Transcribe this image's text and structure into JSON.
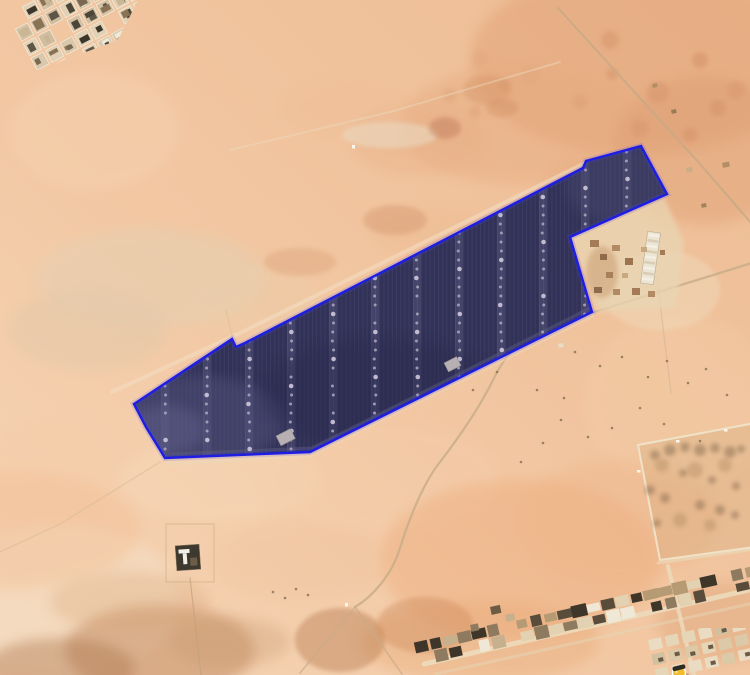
{
  "app": {
    "view": "satellite-imagery",
    "description": "Desert aerial view with a solar farm boundary overlay"
  },
  "canvas": {
    "width": 750,
    "height": 675
  },
  "sand": {
    "base_light": "#f6d6b8",
    "base_mid": "#f2c7a2",
    "base_deep": "#edbc94",
    "blotches": [
      [
        640,
        60,
        170,
        95,
        "#e2a176",
        0.5,
        0
      ],
      [
        520,
        125,
        120,
        60,
        "#e5a77d",
        0.4,
        0
      ],
      [
        705,
        150,
        90,
        75,
        "#dc9a6e",
        0.38,
        0
      ],
      [
        420,
        140,
        70,
        35,
        "#e7ad85",
        0.35,
        0
      ],
      [
        345,
        108,
        65,
        30,
        "#eebc95",
        0.3,
        0
      ],
      [
        150,
        278,
        115,
        50,
        "#e4cfb2",
        0.5,
        0
      ],
      [
        88,
        330,
        80,
        40,
        "#ddc7a9",
        0.38,
        0
      ],
      [
        252,
        300,
        70,
        32,
        "#e9d0ae",
        0.3,
        0
      ],
      [
        95,
        130,
        85,
        60,
        "#f6d2b0",
        0.45,
        0
      ],
      [
        40,
        480,
        70,
        60,
        "#f4cba6",
        0.3,
        0
      ],
      [
        220,
        480,
        100,
        42,
        "#f7d9b9",
        0.4,
        0
      ],
      [
        380,
        478,
        120,
        55,
        "#f5cfad",
        0.35,
        0
      ],
      [
        680,
        400,
        95,
        85,
        "#f3cda6",
        0.4,
        0
      ],
      [
        660,
        290,
        60,
        40,
        "#f0dcbf",
        0.45,
        1
      ],
      [
        520,
        560,
        140,
        80,
        "#edaa7a",
        0.42,
        0
      ],
      [
        620,
        520,
        100,
        60,
        "#eeb286",
        0.35,
        0
      ],
      [
        480,
        642,
        120,
        40,
        "#e8a874",
        0.38,
        0
      ],
      [
        720,
        622,
        62,
        40,
        "#d99a6c",
        0.32,
        0
      ],
      [
        60,
        600,
        120,
        75,
        "#f4dec4",
        0.6,
        0
      ],
      [
        0,
        530,
        140,
        60,
        "#f2bd92",
        0.4,
        0
      ],
      [
        160,
        650,
        95,
        45,
        "#b97f52",
        0.45,
        0
      ],
      [
        60,
        668,
        75,
        30,
        "#a86f46",
        0.4,
        0
      ],
      [
        230,
        642,
        60,
        25,
        "#c79a6f",
        0.32,
        0
      ],
      [
        130,
        602,
        80,
        30,
        "#d8a577",
        0.3,
        0
      ],
      [
        340,
        640,
        45,
        32,
        "#b5794e",
        0.42,
        1
      ],
      [
        425,
        625,
        48,
        28,
        "#cf8d5f",
        0.42,
        1
      ],
      [
        300,
        562,
        90,
        40,
        "#eec39b",
        0.3,
        0
      ],
      [
        390,
        135,
        48,
        13,
        "#ead9c0",
        0.6,
        1
      ],
      [
        445,
        128,
        16,
        11,
        "#c0795a",
        0.45,
        1
      ],
      [
        487,
        90,
        24,
        15,
        "#d79667",
        0.4,
        1
      ],
      [
        502,
        108,
        16,
        9,
        "#cf8d60",
        0.35,
        1
      ],
      [
        600,
        180,
        52,
        26,
        "#e6a87c",
        0.3,
        0
      ],
      [
        430,
        230,
        60,
        24,
        "#ecb68c",
        0.28,
        0
      ],
      [
        395,
        220,
        32,
        15,
        "#d1926a",
        0.4,
        1
      ],
      [
        300,
        262,
        36,
        14,
        "#d79b72",
        0.35,
        1
      ]
    ],
    "freckles": [
      [
        610,
        40,
        9,
        "#d4936a",
        0.5
      ],
      [
        658,
        92,
        11,
        "#d4936a",
        0.45
      ],
      [
        700,
        60,
        8,
        "#cf8b60",
        0.45
      ],
      [
        580,
        102,
        7,
        "#d99c72",
        0.4
      ],
      [
        640,
        128,
        9,
        "#d4936a",
        0.4
      ],
      [
        718,
        108,
        8,
        "#cf8b60",
        0.4
      ],
      [
        480,
        58,
        8,
        "#dda47c",
        0.35
      ],
      [
        450,
        95,
        7,
        "#d99c72",
        0.35
      ],
      [
        530,
        75,
        9,
        "#dda47c",
        0.35
      ],
      [
        690,
        135,
        7,
        "#cf8b60",
        0.4
      ],
      [
        736,
        90,
        9,
        "#d4936a",
        0.4
      ],
      [
        612,
        74,
        6,
        "#cf8b60",
        0.4
      ],
      [
        505,
        85,
        6,
        "#d4936a",
        0.35
      ],
      [
        475,
        112,
        6,
        "#d99c72",
        0.35
      ]
    ],
    "shrub_color": "#7c6a4e",
    "shrub_specks": [
      [
        575,
        352
      ],
      [
        600,
        366
      ],
      [
        622,
        357
      ],
      [
        648,
        377
      ],
      [
        667,
        361
      ],
      [
        688,
        383
      ],
      [
        706,
        369
      ],
      [
        727,
        395
      ],
      [
        640,
        408
      ],
      [
        612,
        428
      ],
      [
        664,
        424
      ],
      [
        700,
        441
      ],
      [
        588,
        437
      ],
      [
        561,
        420
      ],
      [
        543,
        443
      ],
      [
        521,
        462
      ],
      [
        473,
        390
      ],
      [
        497,
        372
      ],
      [
        537,
        390
      ],
      [
        564,
        398
      ],
      [
        273,
        592
      ],
      [
        285,
        598
      ],
      [
        296,
        589
      ],
      [
        308,
        595
      ]
    ],
    "white_speck_color": "#fbf8ef",
    "white_specks": [
      [
        352,
        145
      ],
      [
        345,
        603
      ]
    ]
  },
  "roads": {
    "paths": [
      {
        "name": "road-north",
        "d": "M558,8 L700,164 L752,224",
        "w": 2,
        "c": "#c6a985",
        "o": 0.8
      },
      {
        "name": "road-main",
        "d": "M755,262 L562,322 C520,334 505,355 492,382 C478,410 460,436 440,462 C424,482 410,516 400,548 C392,575 372,597 355,607",
        "w": 2.2,
        "c": "#c9ad89",
        "o": 0.85
      },
      {
        "name": "road-branch-left",
        "d": "M355,607 L300,673",
        "w": 1.6,
        "c": "#c9ad89",
        "o": 0.7
      },
      {
        "name": "road-branch-right",
        "d": "M355,607 L402,674",
        "w": 1.6,
        "c": "#c9ad89",
        "o": 0.7
      },
      {
        "name": "road-facility",
        "d": "M657,278 L671,393",
        "w": 1.2,
        "c": "#cdb190",
        "o": 0.5
      },
      {
        "name": "town-road-main",
        "d": "M424,664 L758,588",
        "w": 5,
        "c": "#ecdabb",
        "o": 0.9
      },
      {
        "name": "town-road-lower",
        "d": "M436,674 L758,602",
        "w": 3,
        "c": "#e6d2b0",
        "o": 0.6
      },
      {
        "name": "town-road-cross",
        "d": "M668,566 L694,675",
        "w": 4,
        "c": "#ecdabb",
        "o": 0.85
      },
      {
        "name": "enclosure-road",
        "d": "M658,563 L755,549",
        "w": 3,
        "c": "#ead8b8",
        "o": 0.7
      },
      {
        "name": "cleared-strip-top",
        "d": "M112,392 L238,334 L585,163",
        "w": 4,
        "c": "#f2dfc2",
        "o": 0.55
      },
      {
        "name": "cleared-strip-bottom",
        "d": "M168,464 L310,455 L592,315",
        "w": 5,
        "c": "#eed7b8",
        "o": 0.45
      },
      {
        "name": "track-southwest",
        "d": "M160,462 L60,524 L0,552",
        "w": 1.5,
        "c": "#d9bb97",
        "o": 0.55
      },
      {
        "name": "track-notch",
        "d": "M233,341 L226,310",
        "w": 1.2,
        "c": "#d9bb97",
        "o": 0.5
      },
      {
        "name": "track-north",
        "d": "M230,150 L390,112 L560,62",
        "w": 2,
        "c": "#ecd9bd",
        "o": 0.45
      },
      {
        "name": "fence-line",
        "d": "M190,578 L201,675",
        "w": 1.2,
        "c": "#c1a17c",
        "o": 0.7
      }
    ]
  },
  "solar_farm": {
    "boundary_color": "#1d1de4",
    "halo_color": "#4646ff",
    "fill": "#323258",
    "points": [
      [
        641,
        146
      ],
      [
        667,
        194
      ],
      [
        570,
        237
      ],
      [
        592,
        312
      ],
      [
        310,
        452
      ],
      [
        165,
        458
      ],
      [
        146,
        427
      ],
      [
        134,
        404
      ],
      [
        232,
        339
      ],
      [
        236,
        347
      ],
      [
        245,
        343
      ],
      [
        583,
        168
      ],
      [
        586,
        161
      ]
    ],
    "column_xs": [
      165,
      207,
      249,
      291,
      333,
      375,
      417,
      459,
      501,
      543,
      585,
      627,
      669
    ],
    "dot_color": "#b7afc4",
    "dot_bright": "#cfc8da",
    "dot_spacing": 9,
    "stripe_line": "rgba(200,200,230,0.07)",
    "stripe_band": "rgba(160,158,190,0.16)",
    "inner_road": {
      "d": "M590,308 L312,448 L170,454",
      "c": "#5f5f86",
      "w": 3,
      "o": 0.45
    },
    "inner_buildings": [
      [
        276,
        436,
        16,
        11
      ],
      [
        444,
        363,
        14,
        10
      ]
    ],
    "inner_building_color": "#b6b0b2",
    "light_zones": [
      [
        195,
        420,
        90,
        45,
        "#55557e",
        0.45
      ],
      [
        625,
        185,
        60,
        40,
        "#4a4a72",
        0.45
      ],
      [
        380,
        395,
        120,
        55,
        "#2c2c50",
        0.4
      ],
      [
        165,
        430,
        40,
        25,
        "#60608a",
        0.5
      ]
    ]
  },
  "facility": {
    "ground_path": "M570,238 L664,197 L684,242 L676,308 L598,312 L584,272 Z",
    "ground_fill": "#e9d5b2",
    "dirt_patch": [
      602,
      272,
      16,
      26,
      "#c79a6f",
      0.5
    ],
    "long_building": {
      "x": 644,
      "y": 232,
      "w": 13,
      "h": 52,
      "rot": 8,
      "fill": "#ece5d4",
      "edge": "#b9ac90",
      "row_a": "#d9cdb4",
      "row_b": "#f4efe3",
      "rows": 9
    },
    "buildings": [
      [
        590,
        240,
        9,
        7,
        "#a57b57"
      ],
      [
        600,
        254,
        7,
        6,
        "#8f6b4b"
      ],
      [
        612,
        245,
        8,
        6,
        "#b28a63"
      ],
      [
        625,
        258,
        8,
        7,
        "#9b7450"
      ],
      [
        606,
        272,
        7,
        6,
        "#a87f5a"
      ],
      [
        594,
        287,
        8,
        6,
        "#8f6b4b"
      ],
      [
        613,
        289,
        7,
        6,
        "#b28a63"
      ],
      [
        632,
        288,
        8,
        7,
        "#a57b57"
      ],
      [
        641,
        247,
        6,
        5,
        "#c7a87f"
      ],
      [
        622,
        273,
        6,
        5,
        "#c7a87f"
      ],
      [
        648,
        291,
        7,
        6,
        "#b28a63"
      ],
      [
        660,
        250,
        5,
        5,
        "#a57b57"
      ]
    ]
  },
  "town_topleft": {
    "angle": -28,
    "cell": 13.5,
    "pitch": 16.5,
    "rows": 8,
    "cols": 12,
    "clip": "0,0 138,0 118,40 0,84",
    "wall_colors": [
      "#dac8ad",
      "#d0bda0",
      "#e1d1b7",
      "#d5c2a6"
    ],
    "interior_colors": [
      "#4d4537",
      "#efe9da",
      "#8a7354",
      "#5d5545",
      "#c9b694",
      "#3c362b",
      "#7a6850"
    ],
    "street_color": "#f0e7d3",
    "seed": 7
  },
  "town_strip": {
    "p0": [
      424,
      652
    ],
    "p1": [
      754,
      577
    ],
    "count": 24,
    "angle": -12.8,
    "colors": [
      "#5a4c3b",
      "#c7b08d",
      "#8d7a5f",
      "#e2d2b2",
      "#3f362a",
      "#b59a74",
      "#efe8d6"
    ],
    "seed": 11
  },
  "corner_grid": {
    "origin": [
      648,
      640
    ],
    "cols": 6,
    "rows": 3,
    "cw": 17,
    "ch": 15,
    "cell_w": 13,
    "cell_h": 11,
    "angle": -12.5,
    "clip": [
      645,
      628,
      105,
      47
    ],
    "colors": [
      "#e6d6b8",
      "#dbc9a8",
      "#e9dcc2",
      "#d2c1a0"
    ],
    "dark": "#6b5b44",
    "seed": 5
  },
  "enclosure": {
    "path": "M638,445 L755,423 L755,547 L660,560 Z",
    "fill": "#cfa879",
    "fill_opacity": 0.3,
    "wall": "#f0e2c6",
    "dark_blobs": [
      [
        655,
        455,
        5
      ],
      [
        670,
        450,
        6
      ],
      [
        685,
        447,
        5
      ],
      [
        700,
        450,
        6
      ],
      [
        715,
        448,
        5
      ],
      [
        730,
        452,
        6
      ],
      [
        741,
        449,
        4
      ],
      [
        650,
        490,
        5
      ],
      [
        665,
        498,
        5
      ],
      [
        700,
        505,
        5
      ],
      [
        720,
        510,
        5
      ],
      [
        735,
        515,
        4
      ],
      [
        657,
        523,
        4
      ],
      [
        683,
        473,
        4
      ],
      [
        712,
        480,
        4
      ],
      [
        736,
        486,
        4
      ]
    ],
    "dark_color": "#7f6549",
    "light_blobs": [
      [
        662,
        465,
        7
      ],
      [
        695,
        470,
        8
      ],
      [
        725,
        465,
        7
      ],
      [
        680,
        520,
        7
      ],
      [
        710,
        525,
        6
      ]
    ],
    "light_color": "#b08a60",
    "gates": [
      [
        637,
        470
      ],
      [
        676,
        440
      ],
      [
        724,
        429
      ]
    ]
  },
  "guard_building": {
    "fence": [
      166,
      524,
      48,
      58
    ],
    "fence_color": "#c8a87f",
    "body": [
      176,
      545,
      24,
      25
    ],
    "body_color": "#3f382e",
    "roof_color": "#f2efe6",
    "shed_color": "#6b5d48"
  },
  "misc_buildings": [
    [
      652,
      84,
      5,
      4,
      "#b28e66"
    ],
    [
      671,
      110,
      5,
      4,
      "#9c7a56"
    ],
    [
      686,
      168,
      6,
      5,
      "#c8ad86"
    ],
    [
      722,
      163,
      7,
      5,
      "#b28e66"
    ],
    [
      701,
      204,
      5,
      4,
      "#a3825f"
    ],
    [
      490,
      607,
      10,
      8,
      "#6b5b45"
    ],
    [
      505,
      615,
      9,
      7,
      "#c7b08d"
    ],
    [
      470,
      625,
      8,
      7,
      "#8d7a5f"
    ],
    [
      558,
      344,
      5,
      4,
      "#e8dcc4"
    ]
  ],
  "pegman": {
    "body_color": "#f2bd2a",
    "band_color": "#2e2a24",
    "outline": "#ffffff",
    "cx": 679,
    "cy": 673,
    "r": 6.5
  }
}
